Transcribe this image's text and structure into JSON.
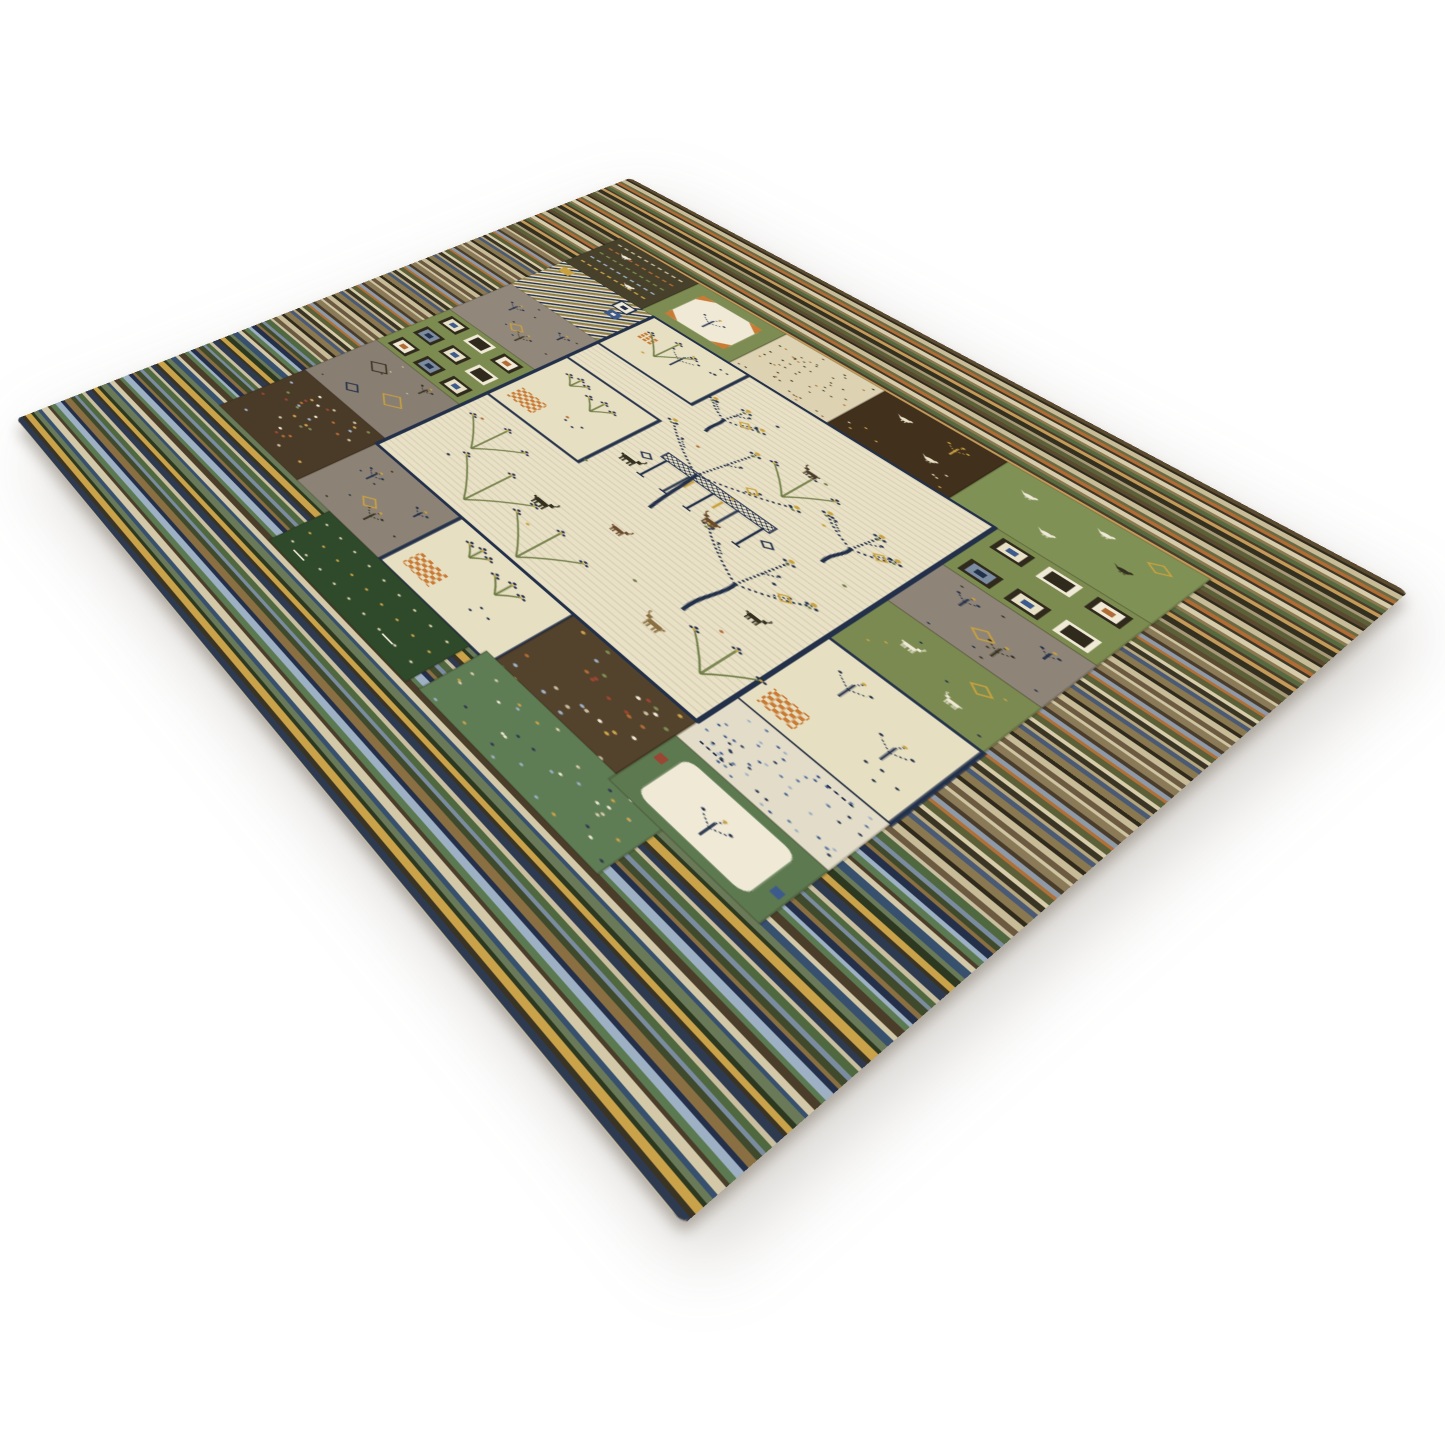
{
  "scene": {
    "description": "Product photograph of a hand-knotted wool Gabbeh-style patchwork area rug, shown flat at a perspective angle on a seamless white studio background with a soft shadow under its near edges",
    "background_color": "#ffffff",
    "shadow_color": "rgba(110,100,85,0.4)"
  },
  "rug": {
    "flat_width": 760,
    "flat_height": 1100,
    "palette": {
      "navy": "#22304a",
      "navy_dark": "#18233a",
      "cream_field": "#e9e1c6",
      "cream_panel": "#e7dfc2",
      "cream_bright": "#efe9d6",
      "gold": "#c9a23f",
      "orange": "#c97b35",
      "rust": "#b06c34",
      "red": "#9a4632",
      "green_patch": "#7c8b4f",
      "green_bright": "#7f9155",
      "green_mid": "#7a8a50",
      "green_deep": "#2e4a2b",
      "green_frame": "#5d7950",
      "green_meadow": "#5f7d55",
      "brown_dark": "#40301c",
      "brown": "#4a3a28",
      "brown_deep": "#53422c",
      "garden_brown": "#47402a",
      "gray_warm": "#92877b",
      "gray_cool": "#897e72",
      "olive": "#6b7a42",
      "slate": "#7b8ca0",
      "blue": "#3c5a8c",
      "steel": "#5c7aa0",
      "skyblue": "#9db0c4"
    },
    "stripes": {
      "heights": [
        7,
        4,
        9,
        5,
        6,
        4,
        8,
        5,
        7,
        4,
        6,
        9,
        5,
        8
      ],
      "bands": [
        {
          "until": 265,
          "colors": [
            "#5a4a30",
            "#2f2a1c",
            "#c8bb97",
            "#6a6b44",
            "#b06c34",
            "#3c3627",
            "#d6cbaa",
            "#8a7850",
            "#57693f",
            "#4a3c2a",
            "#c49a58",
            "#33301f",
            "#a89a78",
            "#5c6038"
          ]
        },
        {
          "until": 700,
          "colors": [
            "#6b5a40",
            "#cfc4a2",
            "#8a7a58",
            "#4a3c2a",
            "#8e9aa8",
            "#b07038",
            "#5c6038",
            "#d8cdaa",
            "#3a3424",
            "#b5a67e",
            "#4a5a74",
            "#8a7850",
            "#2f2a1c",
            "#c8bb97"
          ]
        },
        {
          "until": 1100,
          "colors": [
            "#2e3a50",
            "#c9bfa0",
            "#50683f",
            "#7b8ca0",
            "#3f4a2c",
            "#8a6f42",
            "#24304a",
            "#9db0c4",
            "#5c7a52",
            "#4a3e2a",
            "#d3c9a8",
            "#37506e",
            "#6a7a58",
            "#2c3820",
            "#caa24a",
            "#3a3424"
          ]
        }
      ]
    },
    "field": {
      "x": 205,
      "y": 265,
      "w": 350,
      "h": 485,
      "fill": "#e9e1c6",
      "stroke": "#22304a"
    },
    "patches": [
      {
        "x": 85,
        "y": 150,
        "w": 105,
        "h": 115,
        "bg": "#47402a",
        "motif": "garden"
      },
      {
        "x": 190,
        "y": 150,
        "w": 105,
        "h": 115,
        "bg": "#7d8c52",
        "motif": "medallion"
      },
      {
        "x": 295,
        "y": 150,
        "w": 105,
        "h": 115,
        "bg": "#ddd3b2",
        "motif": "stipple_dark"
      },
      {
        "x": 400,
        "y": 150,
        "w": 115,
        "h": 115,
        "bg": "#40301c",
        "motif": "animals_dark"
      },
      {
        "x": 515,
        "y": 150,
        "w": 160,
        "h": 115,
        "bg": "#7f9155",
        "motif": "birds"
      },
      {
        "x": 85,
        "y": 265,
        "w": 120,
        "h": 105,
        "bg": "#d9cfae",
        "motif": "mini_stripes"
      },
      {
        "x": 85,
        "y": 370,
        "w": 120,
        "h": 115,
        "bg": "#92877b",
        "motif": "gray_trees"
      },
      {
        "x": 85,
        "y": 485,
        "w": 120,
        "h": 130,
        "bg": "#7c8b4f",
        "motif": "square_grid"
      },
      {
        "x": 85,
        "y": 615,
        "w": 120,
        "h": 120,
        "bg": "#897e72",
        "motif": "diamonds"
      },
      {
        "x": 85,
        "y": 735,
        "w": 120,
        "h": 135,
        "bg": "#4a3a28",
        "motif": "confetti"
      },
      {
        "x": 555,
        "y": 265,
        "w": 120,
        "h": 100,
        "bg": "#7c8b4f",
        "motif": "square_grid"
      },
      {
        "x": 555,
        "y": 365,
        "w": 120,
        "h": 95,
        "bg": "#8f8478",
        "motif": "gray_trees"
      },
      {
        "x": 555,
        "y": 460,
        "w": 120,
        "h": 95,
        "bg": "#7a8a50",
        "motif": "green_animals"
      },
      {
        "x": 555,
        "y": 555,
        "w": 120,
        "h": 140,
        "bg": "#e7dfc2",
        "motif": "trees_checker",
        "outlined": true
      },
      {
        "x": 555,
        "y": 695,
        "w": 120,
        "h": 85,
        "bg": "#e3dcc8",
        "motif": "blue_stipple"
      },
      {
        "x": 205,
        "y": 750,
        "w": 110,
        "h": 120,
        "bg": "#8d8276",
        "motif": "gray_trees"
      },
      {
        "x": 315,
        "y": 750,
        "w": 125,
        "h": 120,
        "bg": "#e7dfc2",
        "motif": "checker_plant",
        "outlined": true
      },
      {
        "x": 440,
        "y": 750,
        "w": 115,
        "h": 120,
        "bg": "#53422c",
        "motif": "confetti"
      },
      {
        "x": 250,
        "y": 870,
        "w": 170,
        "h": 85,
        "bg": "#2e4a2b",
        "motif": "plant_rows"
      },
      {
        "x": 430,
        "y": 860,
        "w": 170,
        "h": 90,
        "bg": "#5f7d55",
        "motif": "meadow"
      },
      {
        "x": 555,
        "y": 780,
        "w": 120,
        "h": 90,
        "bg": "#5d7950",
        "motif": "frame_medallion"
      }
    ],
    "inner_panels": [
      {
        "x": 205,
        "y": 265,
        "w": 113,
        "h": 108,
        "bg": "#e7dfc2",
        "motif": "cream_tree"
      },
      {
        "x": 205,
        "y": 430,
        "w": 113,
        "h": 140,
        "bg": "#e7dfc2",
        "motif": "checker_plant"
      }
    ],
    "trees": [
      {
        "x": 390,
        "y": 560,
        "h": 175,
        "spread": 130,
        "lean": -6
      },
      {
        "x": 480,
        "y": 650,
        "h": 150,
        "spread": 100,
        "lean": 4
      },
      {
        "x": 350,
        "y": 400,
        "h": 72,
        "spread": 52,
        "lean": -2
      },
      {
        "x": 505,
        "y": 470,
        "h": 85,
        "spread": 62,
        "lean": 3
      }
    ],
    "plants": [
      {
        "x": 255,
        "y": 660,
        "h": 60
      },
      {
        "x": 300,
        "y": 728,
        "h": 75
      },
      {
        "x": 372,
        "y": 742,
        "h": 68
      },
      {
        "x": 440,
        "y": 420,
        "h": 55
      },
      {
        "x": 528,
        "y": 702,
        "h": 55
      },
      {
        "x": 250,
        "y": 335,
        "h": 48
      }
    ],
    "animals": [
      {
        "x": 340,
        "y": 520,
        "c": "#33301f",
        "s": 1,
        "f": 1
      },
      {
        "x": 428,
        "y": 524,
        "c": "#6a4a2c",
        "s": 0.9,
        "f": -1
      },
      {
        "x": 338,
        "y": 660,
        "c": "#33301f",
        "s": 1,
        "f": 1
      },
      {
        "x": 478,
        "y": 694,
        "c": "#8a6f42",
        "s": 0.95,
        "f": -1
      },
      {
        "x": 435,
        "y": 362,
        "c": "#4a3c2a",
        "s": 0.8,
        "f": -1
      },
      {
        "x": 515,
        "y": 600,
        "c": "#33301f",
        "s": 0.85,
        "f": 1
      },
      {
        "x": 395,
        "y": 620,
        "c": "#6a4a2c",
        "s": 0.8,
        "f": 1
      }
    ],
    "loom": {
      "x": 352,
      "y": 468,
      "w": 110,
      "h": 58
    },
    "field_dots": [
      [
        240,
        340
      ],
      [
        380,
        320
      ],
      [
        450,
        360
      ],
      [
        270,
        520
      ],
      [
        420,
        470
      ],
      [
        500,
        540
      ],
      [
        320,
        560
      ],
      [
        360,
        430
      ],
      [
        480,
        420
      ],
      [
        250,
        690
      ],
      [
        440,
        660
      ],
      [
        510,
        640
      ],
      [
        350,
        695
      ],
      [
        300,
        300
      ],
      [
        530,
        480
      ],
      [
        230,
        610
      ]
    ],
    "dot_colors": [
      "#c9a23f",
      "#22304a",
      "#6b7a42",
      "#b06c34"
    ]
  }
}
